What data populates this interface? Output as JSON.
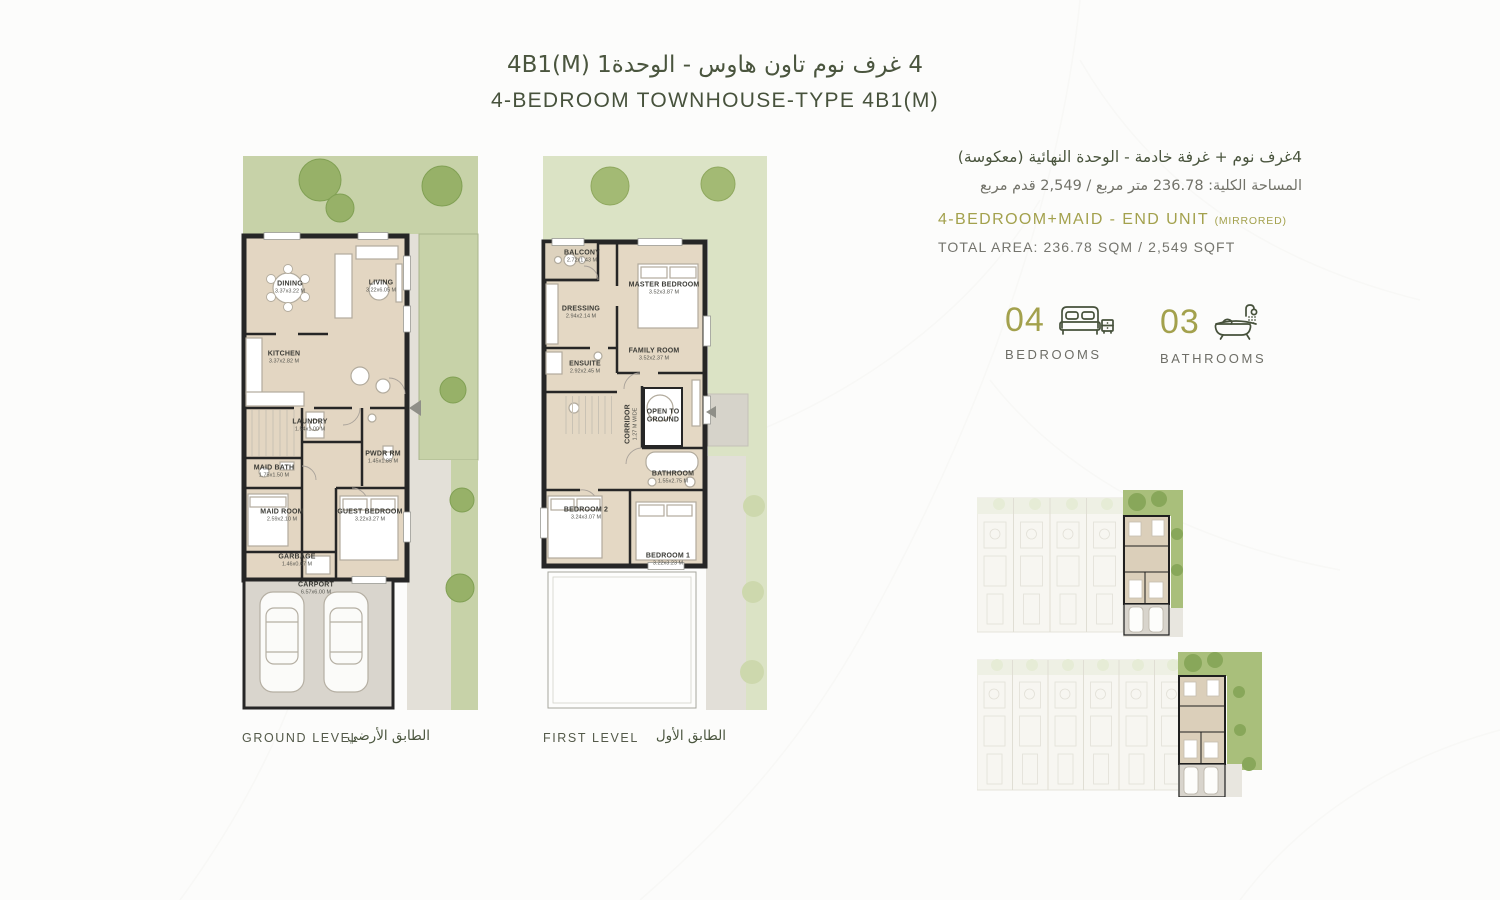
{
  "title": {
    "ar": "4 غرف نوم تاون هاوس - الوحدة1",
    "code": "4B1(M)",
    "en": "4-BEDROOM TOWNHOUSE-TYPE 4B1(M)"
  },
  "info": {
    "ar_line1": "4غرف نوم + غرفة خادمة - الوحدة النهائية (معكوسة)",
    "ar_line2": "المساحة الكلية: 236.78 متر مربع / 2,549 قدم مربع",
    "en_line1": "4-BEDROOM+MAID - END UNIT",
    "en_line1_suffix": "(MIRRORED)",
    "en_line2": "TOTAL AREA: 236.78 SQM / 2,549 SQFT"
  },
  "stats": {
    "bedrooms": {
      "value": "04",
      "label": "BEDROOMS",
      "icon": "bed-icon"
    },
    "bathrooms": {
      "value": "03",
      "label": "BATHROOMS",
      "icon": "bathtub-icon"
    }
  },
  "ground": {
    "caption_en": "GROUND LEVEL",
    "caption_ar": "الطابق الأرضي",
    "rooms": [
      {
        "name": "DINING",
        "dims": "3.37x3.22 M"
      },
      {
        "name": "LIVING",
        "dims": "3.22x6.05 M"
      },
      {
        "name": "KITCHEN",
        "dims": "3.37x2.82 M"
      },
      {
        "name": "LAUNDRY",
        "dims": "1.54x1.00 M"
      },
      {
        "name": "PWDR RM",
        "dims": "1.45x1.85 M"
      },
      {
        "name": "MAID BATH",
        "dims": "1.75x1.50 M"
      },
      {
        "name": "MAID ROOM",
        "dims": "2.59x2.10 M"
      },
      {
        "name": "GUEST BEDROOM",
        "dims": "3.22x3.27 M"
      },
      {
        "name": "GARBAGE",
        "dims": "1.46x0.67 M"
      },
      {
        "name": "CARPORT",
        "dims": "6.57x6.00 M"
      }
    ]
  },
  "first": {
    "caption_en": "FIRST LEVEL",
    "caption_ar": "الطابق الأول",
    "rooms": [
      {
        "name": "BALCONY",
        "dims": "2.72x1.43 M"
      },
      {
        "name": "MASTER BEDROOM",
        "dims": "3.52x3.87 M"
      },
      {
        "name": "DRESSING",
        "dims": "2.94x2.14 M"
      },
      {
        "name": "ENSUITE",
        "dims": "2.92x2.45 M"
      },
      {
        "name": "FAMILY ROOM",
        "dims": "3.52x2.37 M"
      },
      {
        "name": "CORRIDOR",
        "dims": "1.27 M WIDE"
      },
      {
        "name": "OPEN TO GROUND",
        "dims": ""
      },
      {
        "name": "BATHROOM",
        "dims": "1.55x2.75 M"
      },
      {
        "name": "BEDROOM 2",
        "dims": "3.24x3.07 M"
      },
      {
        "name": "BEDROOM 1",
        "dims": "3.22x3.23 M"
      }
    ]
  },
  "colors": {
    "accent_green": "#47523c",
    "accent_olive": "#a3a14d",
    "garden": "#c7d2a8",
    "garden_light": "#dbe3c5",
    "wall": "#262626",
    "floor": "#e3d6c2"
  }
}
